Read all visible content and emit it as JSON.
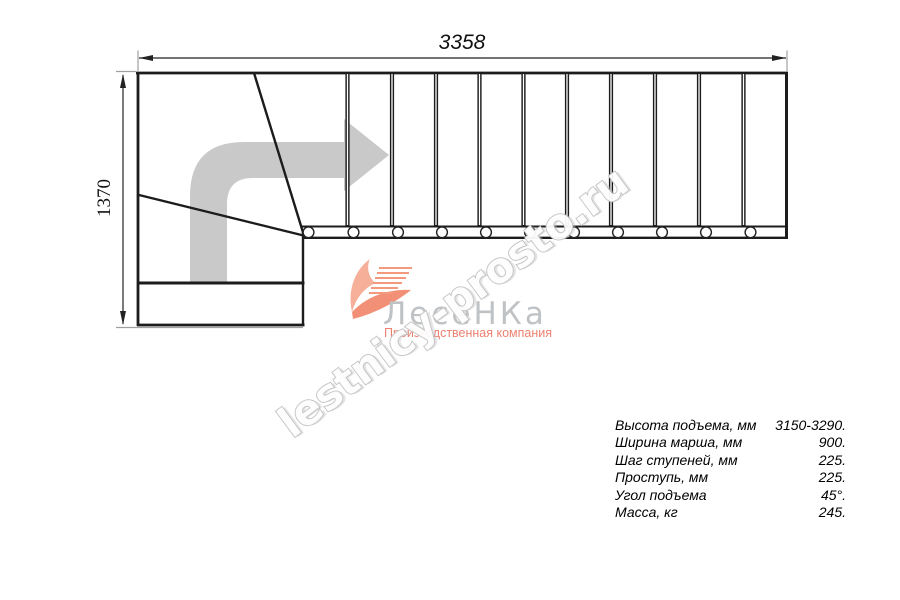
{
  "drawing": {
    "width_mm": "3358",
    "height_mm": "1370",
    "tread_count": 11,
    "line_color": "#1c1c1c",
    "extension_line_color": "#a0a0a0",
    "direction_arrow_color": "#c9c9c9"
  },
  "watermark": {
    "text": "lestnicy-prosto.ru",
    "outline_color": "#c4c4c4"
  },
  "logo": {
    "brand": "ЛесеНКа",
    "tagline": "Производственная компания",
    "brand_color": "#c0c3c5",
    "accent_color": "#ec8170"
  },
  "specs": {
    "rows": [
      {
        "label": "Высота подъема, мм",
        "value": "3150-3290."
      },
      {
        "label": "Ширина марша, мм",
        "value": "900."
      },
      {
        "label": "Шаг ступеней, мм",
        "value": "225."
      },
      {
        "label": "Проступь, мм",
        "value": "225."
      },
      {
        "label": "Угол подъема",
        "value": "45°."
      },
      {
        "label": "Масса, кг",
        "value": "245."
      }
    ]
  }
}
